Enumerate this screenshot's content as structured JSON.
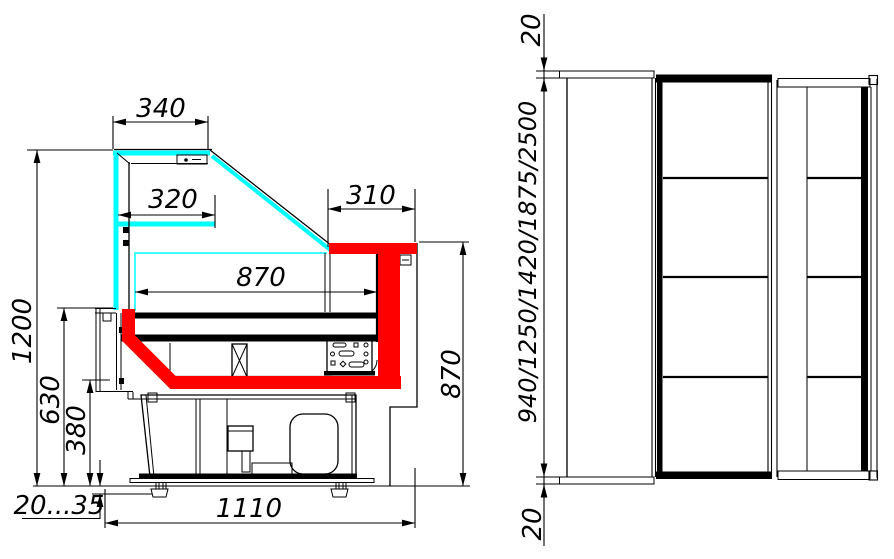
{
  "drawing": {
    "side_view": {
      "label": "side-section",
      "dims": {
        "canopy_width": "340",
        "shelf_depth": "320",
        "worktop_depth": "310",
        "display_width": "870",
        "display_height": "870",
        "overall_height": "1200",
        "counter_height": "630",
        "base_height": "380",
        "foot_range": "20...35",
        "overall_depth": "1110"
      }
    },
    "front_view": {
      "label": "front-elevation",
      "dims": {
        "top_trim": "20",
        "height_options": "940/1250/1420/1875/2500",
        "bottom_trim": "20"
      }
    },
    "colors": {
      "glass": "#00FFFF",
      "accent": "#FF0000",
      "line": "#000000",
      "background": "#FFFFFF"
    }
  }
}
